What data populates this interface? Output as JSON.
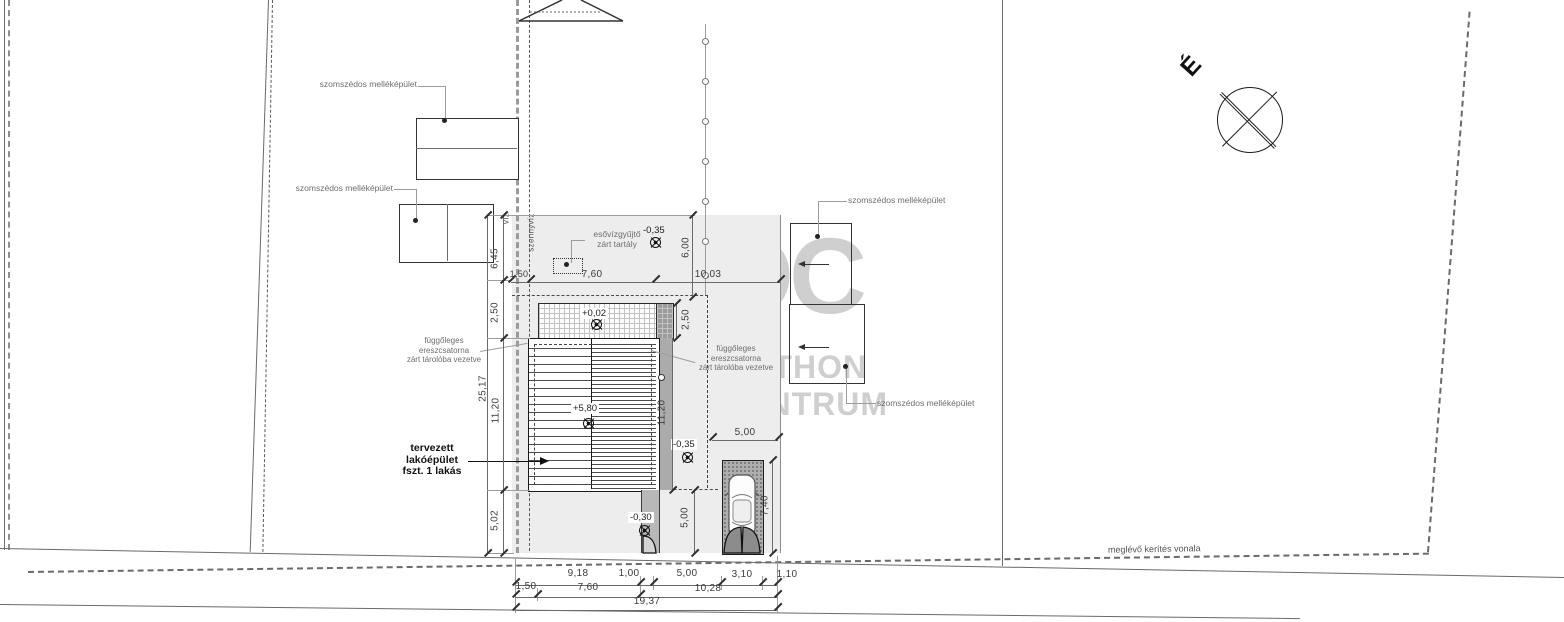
{
  "drawing": {
    "north": {
      "label": "É"
    },
    "watermark": {
      "monogram": "OC",
      "line1": "OTTHON",
      "line2": "CENTRUM"
    },
    "labels": {
      "neighbor_outbuilding": "szomszédos melléképület",
      "rain_tank_line1": "esővízgyűjtő",
      "rain_tank_line2": "zárt tartály",
      "gutter_line1": "függőleges",
      "gutter_line2": "ereszcsatorna",
      "gutter_line3": "zárt tárolóba vezetve",
      "planned_line1": "tervezett",
      "planned_line2": "lakóépület",
      "planned_line3": "fszt. 1 lakás",
      "existing_fence": "meglévő kerítés vonala",
      "water": "víz",
      "sewer": "szennyvíz"
    },
    "elevations": {
      "terrace": "+0,02",
      "ridge": "+5,80",
      "yard_upper": "-0,35",
      "yard_lower": "-0,35",
      "entry": "-0,30"
    },
    "dims": {
      "left": [
        "6,45",
        "2,50",
        "11,20",
        "5,02"
      ],
      "left_total": "25,17",
      "top": [
        "1,50",
        "7,60",
        "10,03"
      ],
      "right_depth": "6,00",
      "right_terrace": "2,50",
      "right_house": "11,20",
      "right_front": "5,00",
      "parking_width": "5,00",
      "parking_depth": "7,40",
      "bottom_row1": [
        "9,18",
        "1,00",
        "5,00",
        "3,10",
        "1,10"
      ],
      "bottom_row2": [
        "1,50",
        "7,60",
        "10,28"
      ],
      "bottom_total": "19,37"
    },
    "colors": {
      "plot_fill": "#ededed",
      "line": "#3a3a3a",
      "watermark": "#c4c4c4"
    }
  }
}
